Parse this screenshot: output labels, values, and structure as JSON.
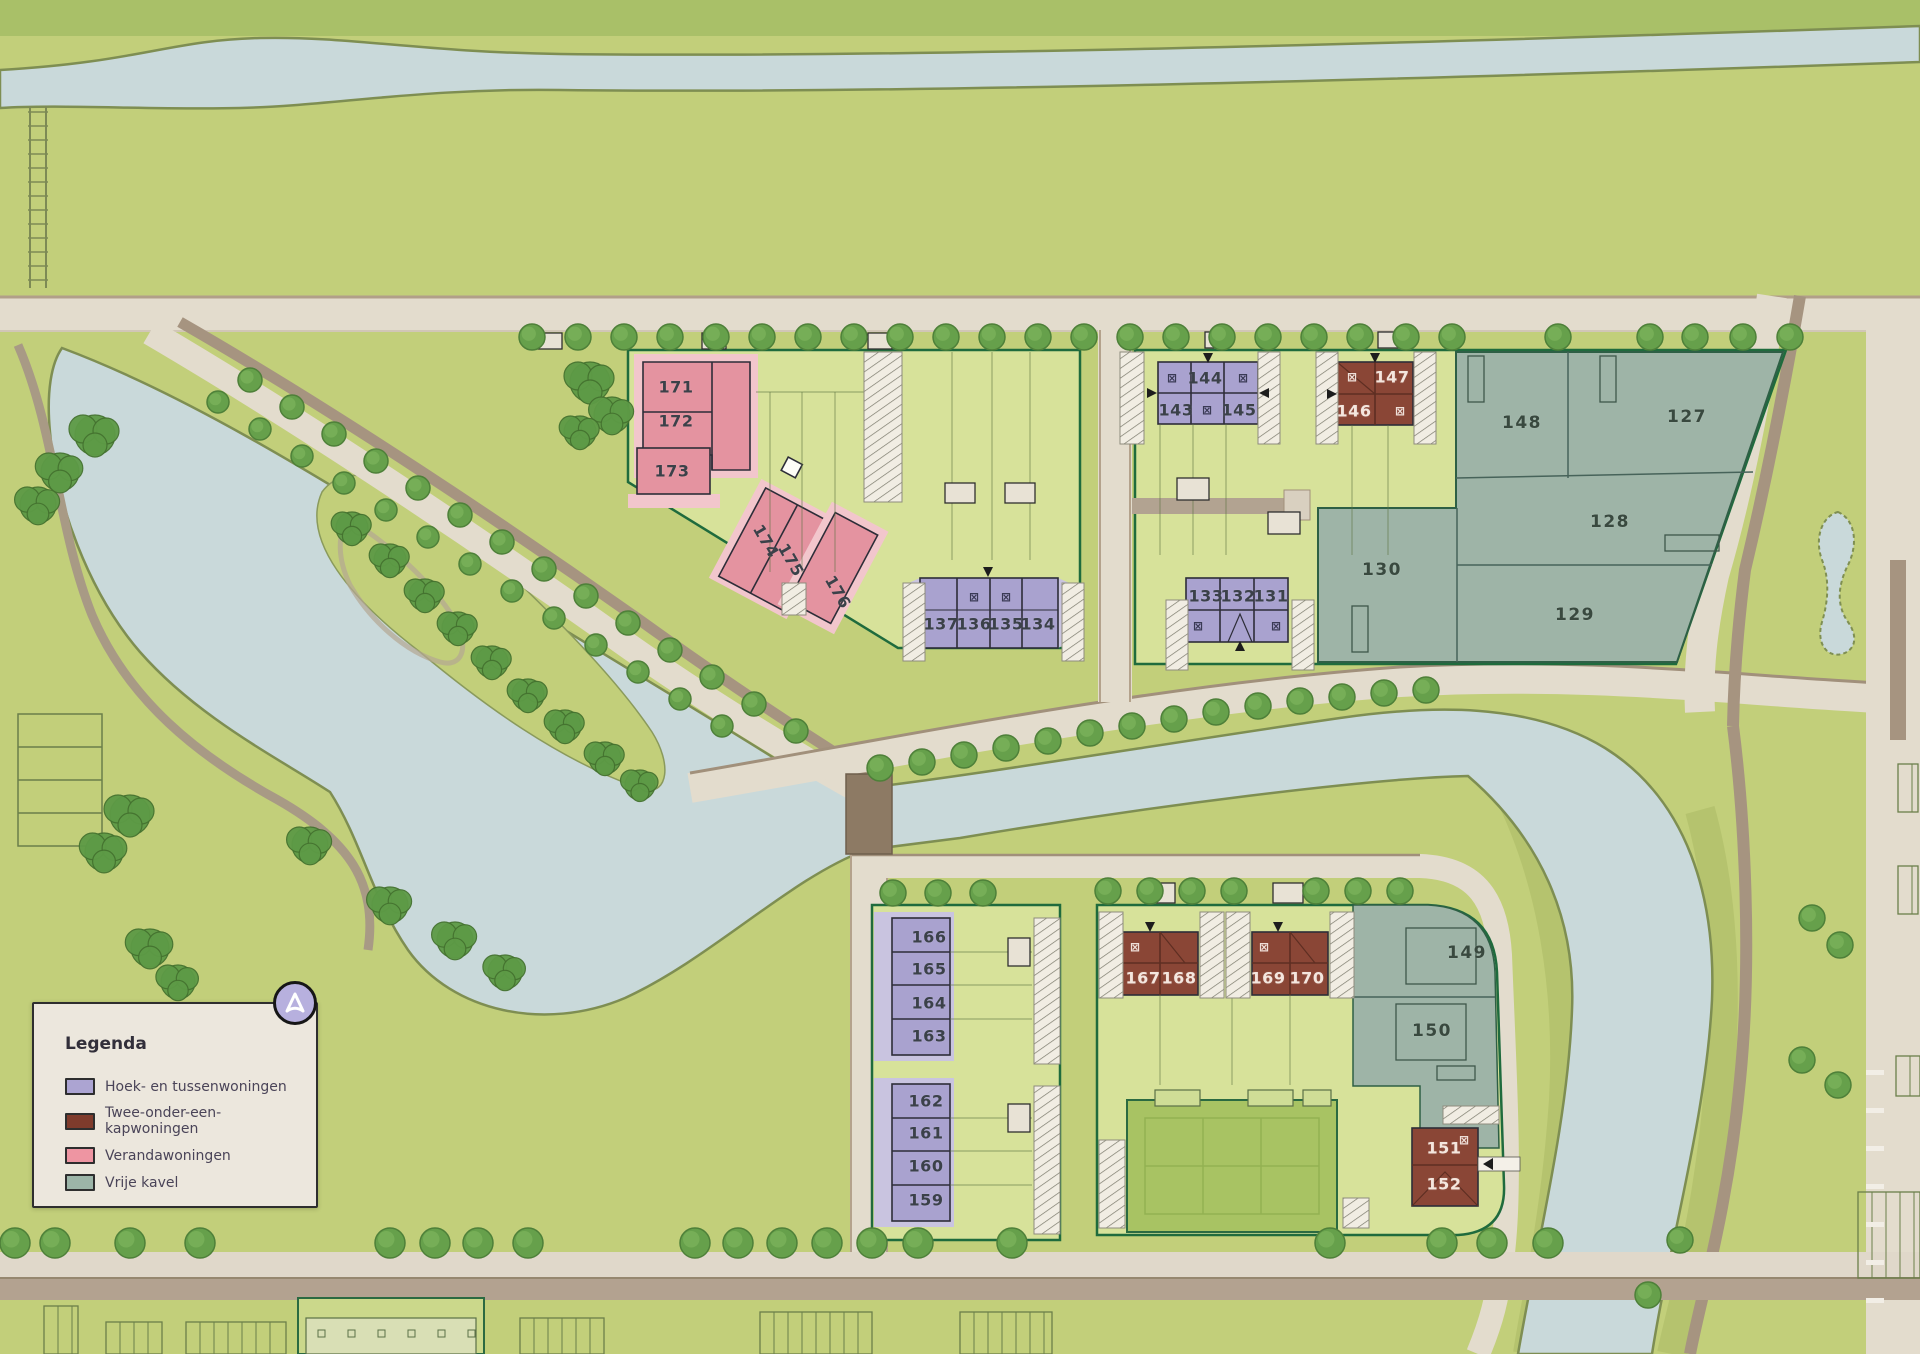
{
  "legend": {
    "title": "Legenda",
    "items": [
      {
        "id": "hoek",
        "label": "Hoek- en tussenwoningen",
        "color": "#aca4d2"
      },
      {
        "id": "tweekap",
        "label": "Twee-onder-een-kapwoningen",
        "color": "#7f3b2c"
      },
      {
        "id": "veranda",
        "label": "Verandawoningen",
        "color": "#ee95a2"
      },
      {
        "id": "vrije",
        "label": "Vrije kavel",
        "color": "#9cb5a8"
      }
    ]
  },
  "compass": {
    "icon": "compass-north-icon"
  },
  "colors": {
    "water": "#c9d9da",
    "road": "#e3dccd",
    "plot_green": "#d7e29a",
    "border_green": "#1f6b3d",
    "building_outline": "#2d2d38"
  },
  "plots": {
    "mark_glyph": "⊠",
    "labels": [
      {
        "n": "171",
        "x": 676,
        "y": 387,
        "type": "veranda"
      },
      {
        "n": "172",
        "x": 676,
        "y": 421,
        "type": "veranda"
      },
      {
        "n": "173",
        "x": 672,
        "y": 471,
        "type": "veranda"
      },
      {
        "n": "174",
        "x": 766,
        "y": 541,
        "type": "veranda",
        "rot": 60
      },
      {
        "n": "175",
        "x": 791,
        "y": 560,
        "type": "veranda",
        "rot": 60
      },
      {
        "n": "176",
        "x": 838,
        "y": 592,
        "type": "veranda",
        "rot": 60
      },
      {
        "n": "137",
        "x": 941,
        "y": 624,
        "type": "hoek"
      },
      {
        "n": "136",
        "x": 974,
        "y": 624,
        "type": "hoek"
      },
      {
        "n": "135",
        "x": 1006,
        "y": 624,
        "type": "hoek"
      },
      {
        "n": "134",
        "x": 1038,
        "y": 624,
        "type": "hoek"
      },
      {
        "n": "144",
        "x": 1205,
        "y": 378,
        "type": "hoek"
      },
      {
        "n": "143",
        "x": 1176,
        "y": 410,
        "type": "hoek"
      },
      {
        "n": "145",
        "x": 1239,
        "y": 410,
        "type": "hoek"
      },
      {
        "n": "147",
        "x": 1392,
        "y": 377,
        "type": "tweekap"
      },
      {
        "n": "146",
        "x": 1354,
        "y": 411,
        "type": "tweekap"
      },
      {
        "n": "148",
        "x": 1522,
        "y": 423,
        "type": "vrije"
      },
      {
        "n": "127",
        "x": 1687,
        "y": 417,
        "type": "vrije"
      },
      {
        "n": "128",
        "x": 1610,
        "y": 522,
        "type": "vrije"
      },
      {
        "n": "129",
        "x": 1575,
        "y": 615,
        "type": "vrije"
      },
      {
        "n": "130",
        "x": 1382,
        "y": 570,
        "type": "vrije"
      },
      {
        "n": "133",
        "x": 1206,
        "y": 596,
        "type": "hoek"
      },
      {
        "n": "132",
        "x": 1238,
        "y": 596,
        "type": "hoek"
      },
      {
        "n": "131",
        "x": 1271,
        "y": 596,
        "type": "hoek"
      },
      {
        "n": "166",
        "x": 929,
        "y": 937,
        "type": "hoek"
      },
      {
        "n": "165",
        "x": 929,
        "y": 969,
        "type": "hoek"
      },
      {
        "n": "164",
        "x": 929,
        "y": 1003,
        "type": "hoek"
      },
      {
        "n": "163",
        "x": 929,
        "y": 1036,
        "type": "hoek"
      },
      {
        "n": "162",
        "x": 926,
        "y": 1101,
        "type": "hoek"
      },
      {
        "n": "161",
        "x": 926,
        "y": 1133,
        "type": "hoek"
      },
      {
        "n": "160",
        "x": 926,
        "y": 1166,
        "type": "hoek"
      },
      {
        "n": "159",
        "x": 926,
        "y": 1200,
        "type": "hoek"
      },
      {
        "n": "167",
        "x": 1143,
        "y": 978,
        "type": "tweekap"
      },
      {
        "n": "168",
        "x": 1179,
        "y": 978,
        "type": "tweekap"
      },
      {
        "n": "169",
        "x": 1268,
        "y": 978,
        "type": "tweekap"
      },
      {
        "n": "170",
        "x": 1307,
        "y": 978,
        "type": "tweekap"
      },
      {
        "n": "149",
        "x": 1467,
        "y": 953,
        "type": "vrije"
      },
      {
        "n": "150",
        "x": 1432,
        "y": 1031,
        "type": "vrije"
      },
      {
        "n": "151",
        "x": 1444,
        "y": 1148,
        "type": "tweekap"
      },
      {
        "n": "152",
        "x": 1444,
        "y": 1184,
        "type": "tweekap"
      }
    ],
    "marks": [
      {
        "x": 974,
        "y": 597,
        "tone": "dark"
      },
      {
        "x": 1006,
        "y": 597,
        "tone": "dark"
      },
      {
        "x": 1172,
        "y": 378,
        "tone": "dark"
      },
      {
        "x": 1243,
        "y": 378,
        "tone": "dark"
      },
      {
        "x": 1207,
        "y": 410,
        "tone": "dark"
      },
      {
        "x": 1352,
        "y": 377,
        "tone": "light"
      },
      {
        "x": 1400,
        "y": 411,
        "tone": "light"
      },
      {
        "x": 1198,
        "y": 626,
        "tone": "dark"
      },
      {
        "x": 1276,
        "y": 626,
        "tone": "dark"
      },
      {
        "x": 1135,
        "y": 947,
        "tone": "light"
      },
      {
        "x": 1264,
        "y": 947,
        "tone": "light"
      },
      {
        "x": 1464,
        "y": 1140,
        "tone": "light"
      }
    ]
  }
}
